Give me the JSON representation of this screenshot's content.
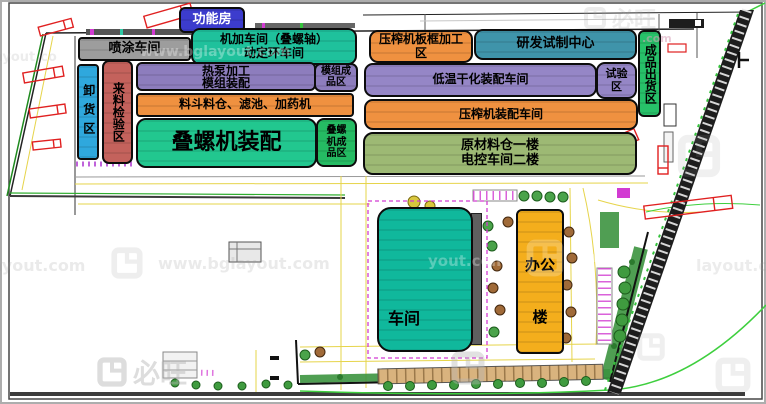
{
  "drawing_title": "工厂总平面布置图",
  "blocks": {
    "function_room": "功能房",
    "spray_workshop": "喷涂车间",
    "machining_workshop": "机加车间（叠螺轴）\n动定环车间",
    "press_plate_frame_area": "压榨机板框加工\n区",
    "rd_trial_center": "研发试制中心",
    "finished_goods_shipping_area": "成品出货区",
    "unloading_area": "卸货区",
    "incoming_inspection_area": "来料检验区",
    "heat_pump_module_assembly": "热泵加工\n模组装配",
    "module_finished_area": "模组成\n品区",
    "low_temp_drying_workshop": "低温干化装配车间",
    "test_area": "试验\n区",
    "hopper_silo_filter_dosing": "料斗料仓、滤池、加药机",
    "press_assembly_workshop": "压榨机装配车间",
    "screw_press_assembly": "叠螺机装配",
    "screw_press_finished_area": "叠螺\n机成\n品区",
    "raw_material_warehouse": "原材料仓一楼\n电控车间二楼",
    "workshop": "车间",
    "office_line1": "办公",
    "office_line2": "楼"
  },
  "colors": {
    "blue": "#3c3ccd",
    "gray": "#9d9d9d",
    "teal_green": "#1fc19c",
    "orange": "#ef9140",
    "teal_blue": "#3f94aa",
    "green": "#27c169",
    "cyan": "#2fa8dd",
    "rose": "#c4625c",
    "purple": "#8d7dbd",
    "purple_light": "#9586c6",
    "bright_green": "#22c78f",
    "mid_green": "#25bb63",
    "olive_green": "#9db974",
    "deep_teal": "#10b89c",
    "amber": "#f4ae1c"
  },
  "watermarks": {
    "brand": "必旺",
    "url": "www.bglayout.com",
    "url_cut_left_upper": "ayout.co",
    "url_cut_left_lower": "layout.com",
    "url_cut_right": "layout.cc",
    "url_cut_mid": "yout.com",
    "url_cut_small": "www",
    "dotcom": ".com"
  }
}
